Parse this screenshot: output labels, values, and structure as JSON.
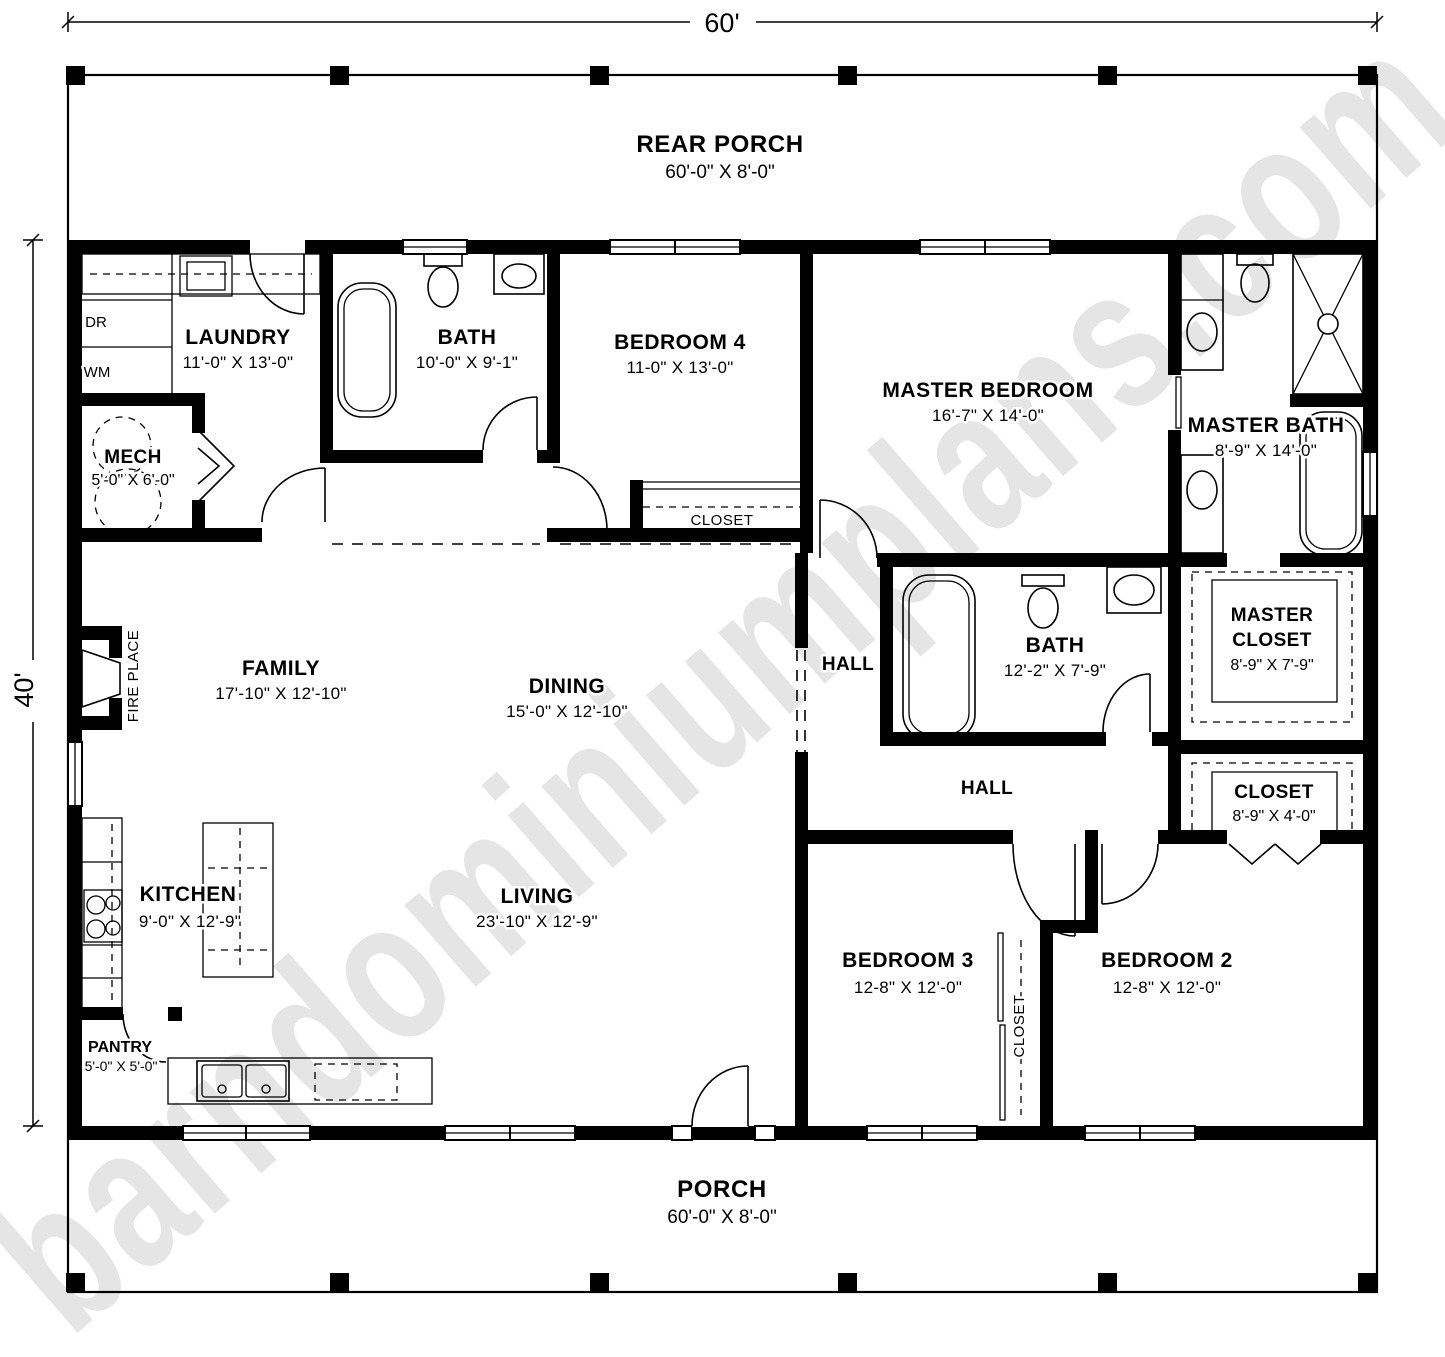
{
  "plan": {
    "overall_width": "60'",
    "overall_depth": "40'",
    "watermark": "barndominiumplans.com",
    "rear_porch": {
      "name": "REAR PORCH",
      "dims": "60'-0\" X 8'-0\""
    },
    "front_porch": {
      "name": "PORCH",
      "dims": "60'-0\" X 8'-0\""
    },
    "rooms": {
      "laundry": {
        "name": "LAUNDRY",
        "dims": "11'-0\" X 13'-0\""
      },
      "mech": {
        "name": "MECH",
        "dims": "5'-0\" X 6'-0\""
      },
      "bath_top": {
        "name": "BATH",
        "dims": "10'-0\" X 9'-1\""
      },
      "bedroom4": {
        "name": "BEDROOM 4",
        "dims": "11-0\" X 13'-0\""
      },
      "bedroom4_closet": {
        "name": "CLOSET"
      },
      "master_bedroom": {
        "name": "MASTER BEDROOM",
        "dims": "16'-7\" X 14'-0\""
      },
      "master_bath": {
        "name": "MASTER BATH",
        "dims": "8'-9\" X 14'-0\""
      },
      "master_closet": {
        "name1": "MASTER",
        "name2": "CLOSET",
        "dims": "8'-9\" X 7'-9\""
      },
      "hall_closet": {
        "name": "CLOSET",
        "dims": "8'-9\" X 4'-0\""
      },
      "family": {
        "name": "FAMILY",
        "dims": "17'-10\" X 12'-10\""
      },
      "dining": {
        "name": "DINING",
        "dims": "15'-0\" X 12'-10\""
      },
      "hall_upper": {
        "name": "HALL"
      },
      "hall_lower": {
        "name": "HALL"
      },
      "bath_mid": {
        "name": "BATH",
        "dims": "12'-2\" X 7'-9\""
      },
      "kitchen": {
        "name": "KITCHEN",
        "dims": "9'-0\" X 12'-9\""
      },
      "living": {
        "name": "LIVING",
        "dims": "23'-10\" X 12'-9\""
      },
      "pantry": {
        "name": "PANTRY",
        "dims": "5'-0\" X 5'-0\""
      },
      "bedroom3": {
        "name": "BEDROOM 3",
        "dims": "12-8\" X 12'-0\""
      },
      "bedroom3_closet": {
        "name": "CLOSET"
      },
      "bedroom2": {
        "name": "BEDROOM 2",
        "dims": "12-8\" X 12'-0\""
      }
    },
    "appliances": {
      "dryer": "DR",
      "washer": "WM",
      "fireplace": "FIRE PLACE"
    }
  }
}
